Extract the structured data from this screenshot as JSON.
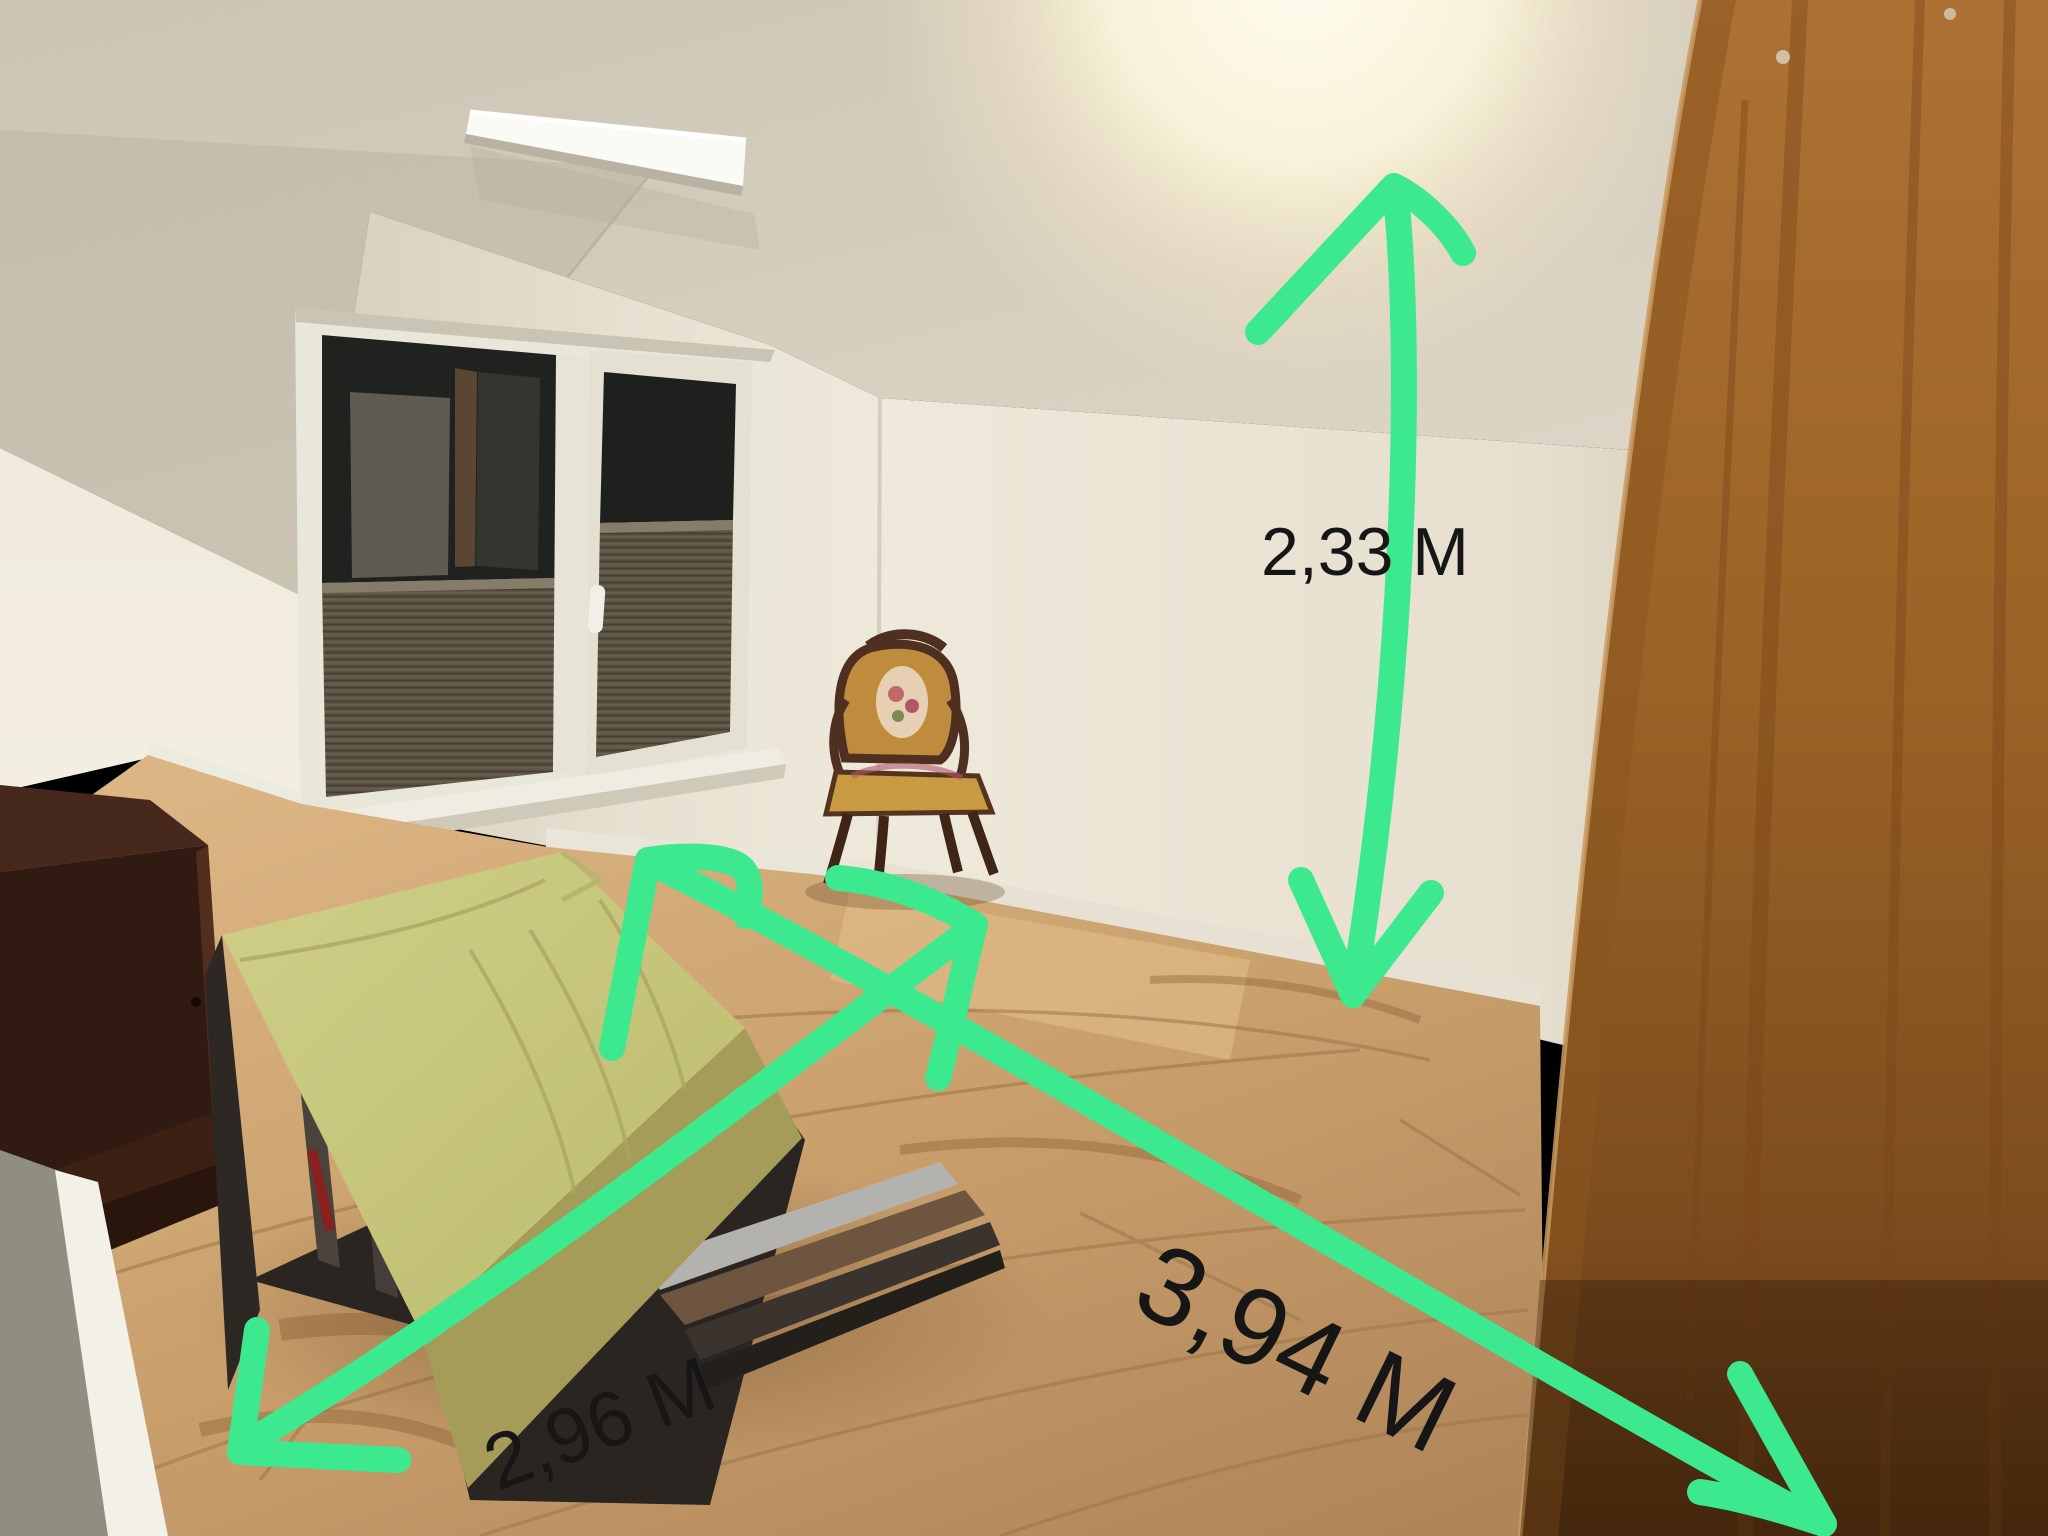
{
  "photo": {
    "kind": "room-photo-with-measurements",
    "scene": "attic bedroom at night",
    "annotation_color": "#3ce98e",
    "label_color": "#161616",
    "measurements": [
      {
        "id": "wall-height",
        "label": "2,33 M",
        "direction": "vertical"
      },
      {
        "id": "room-width",
        "label": "2,96 M",
        "direction": "diagonal-left"
      },
      {
        "id": "room-length",
        "label": "3,94 M",
        "direction": "diagonal-right"
      }
    ],
    "objects": {
      "ceiling_lamp": "round-glow-ceiling-lamp",
      "led_panel": "white-led-ceiling-panel",
      "window": "two-pane-window-dark-glass-pleated-blinds",
      "window_handle": "white-window-handle",
      "armchair": "antique-needlepoint-armchair",
      "bed": "low-platform-bed-green-fitted-sheet",
      "cabinet": "dark-wood-cabinet",
      "wardrobe": "wood-wardrobe-panel",
      "floor": "oak-laminate-floor"
    },
    "palette": {
      "wall": "#e9e2d3",
      "ceiling": "#d5cec0",
      "floor_light": "#d2ab77",
      "floor_dark": "#b2885a",
      "wardrobe": "#a06528",
      "mattress": "#c8c77b",
      "glass": "#1e201e",
      "blind": "#5d5545"
    }
  }
}
